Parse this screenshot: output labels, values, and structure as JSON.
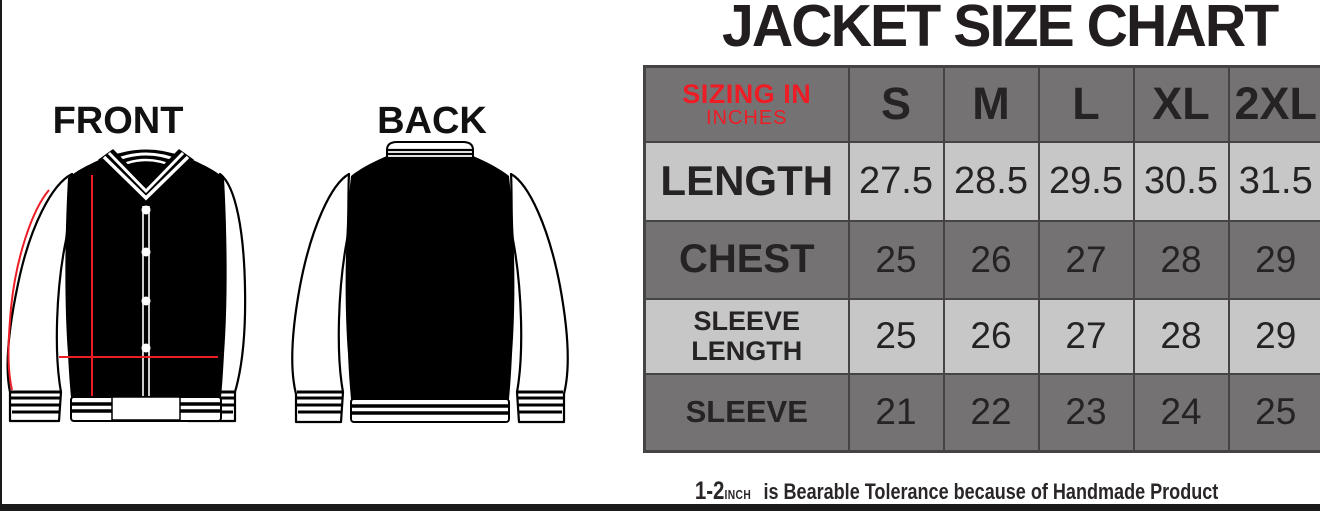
{
  "colors": {
    "dark": "#747273",
    "light": "#c8c7c7",
    "border": "#454344",
    "text": "#262324",
    "red": "#ee1c25",
    "bar": "#1b1a1b",
    "white": "#ffffff"
  },
  "title": "JACKET SIZE CHART",
  "diagram": {
    "front_label": "FRONT",
    "back_label": "BACK"
  },
  "size_chart": {
    "corner_line1": "SIZING IN",
    "corner_line2": "INCHES"
  },
  "chart_data": {
    "type": "table",
    "title": "JACKET SIZE CHART",
    "unit_note": "SIZING IN INCHES",
    "columns": [
      "S",
      "M",
      "L",
      "XL",
      "2XL"
    ],
    "rows": [
      {
        "label": "LENGTH",
        "values": [
          "27.5",
          "28.5",
          "29.5",
          "30.5",
          "31.5"
        ]
      },
      {
        "label": "CHEST",
        "values": [
          "25",
          "26",
          "27",
          "28",
          "29"
        ]
      },
      {
        "label": "SLEEVE LENGTH",
        "values": [
          "25",
          "26",
          "27",
          "28",
          "29"
        ]
      },
      {
        "label": "SLEEVE",
        "values": [
          "21",
          "22",
          "23",
          "24",
          "25"
        ]
      }
    ],
    "footnote": "1-2 INCH is Bearable Tolerance because of Handmade Product"
  },
  "footer": {
    "tolerance_value": "1-2",
    "tolerance_unit": "INCH",
    "tolerance_text": "is Bearable Tolerance because of Handmade Product"
  }
}
